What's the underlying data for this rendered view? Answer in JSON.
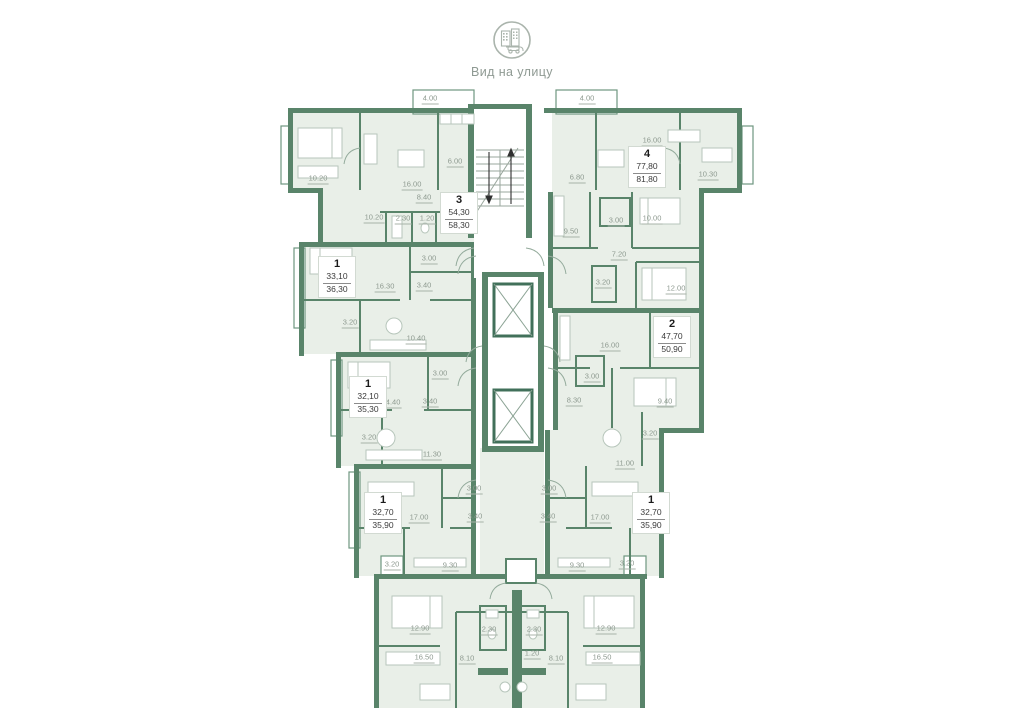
{
  "header": {
    "icon": "street-view-building-icon",
    "caption": "Вид на улицу"
  },
  "plan": {
    "colors": {
      "wall": "#59846a",
      "floor": "#e9efe8",
      "label_text": "#8d998f",
      "apartment_number": "#1b1b1b",
      "furniture": "#b7c6bb"
    },
    "apartments": [
      {
        "number": "3",
        "area_living": "54,30",
        "area_total": "58,30",
        "x": 440,
        "y": 192
      },
      {
        "number": "4",
        "area_living": "77,80",
        "area_total": "81,80",
        "x": 628,
        "y": 146
      },
      {
        "number": "1",
        "area_living": "33,10",
        "area_total": "36,30",
        "x": 318,
        "y": 256
      },
      {
        "number": "1",
        "area_living": "32,10",
        "area_total": "35,30",
        "x": 349,
        "y": 376
      },
      {
        "number": "2",
        "area_living": "47,70",
        "area_total": "50,90",
        "x": 653,
        "y": 316
      },
      {
        "number": "1",
        "area_living": "32,70",
        "area_total": "35,90",
        "x": 364,
        "y": 492
      },
      {
        "number": "1",
        "area_living": "32,70",
        "area_total": "35,90",
        "x": 632,
        "y": 492
      }
    ],
    "room_labels": [
      {
        "value": "4.00",
        "x": 430,
        "y": 100
      },
      {
        "value": "10.20",
        "x": 318,
        "y": 180
      },
      {
        "value": "16.00",
        "x": 412,
        "y": 186
      },
      {
        "value": "6.00",
        "x": 455,
        "y": 163
      },
      {
        "value": "8.40",
        "x": 424,
        "y": 199
      },
      {
        "value": "10.20",
        "x": 374,
        "y": 219
      },
      {
        "value": "2.30",
        "x": 403,
        "y": 220
      },
      {
        "value": "1.20",
        "x": 427,
        "y": 220
      },
      {
        "value": "4.00",
        "x": 587,
        "y": 100
      },
      {
        "value": "16.00",
        "x": 652,
        "y": 142
      },
      {
        "value": "6.80",
        "x": 577,
        "y": 179
      },
      {
        "value": "10.30",
        "x": 708,
        "y": 176
      },
      {
        "value": "9.50",
        "x": 571,
        "y": 233
      },
      {
        "value": "3.00",
        "x": 616,
        "y": 222
      },
      {
        "value": "10.00",
        "x": 652,
        "y": 220
      },
      {
        "value": "7.20",
        "x": 619,
        "y": 256
      },
      {
        "value": "3.20",
        "x": 603,
        "y": 284
      },
      {
        "value": "12.00",
        "x": 676,
        "y": 290
      },
      {
        "value": "16.30",
        "x": 385,
        "y": 288
      },
      {
        "value": "3.40",
        "x": 424,
        "y": 287
      },
      {
        "value": "3.00",
        "x": 429,
        "y": 260
      },
      {
        "value": "3.20",
        "x": 350,
        "y": 324
      },
      {
        "value": "10.40",
        "x": 416,
        "y": 340
      },
      {
        "value": "14.40",
        "x": 391,
        "y": 404
      },
      {
        "value": "3.00",
        "x": 440,
        "y": 375
      },
      {
        "value": "3.40",
        "x": 430,
        "y": 403
      },
      {
        "value": "3.20",
        "x": 369,
        "y": 439
      },
      {
        "value": "11.30",
        "x": 432,
        "y": 456
      },
      {
        "value": "17.00",
        "x": 419,
        "y": 519
      },
      {
        "value": "3.00",
        "x": 474,
        "y": 490
      },
      {
        "value": "3.40",
        "x": 475,
        "y": 518
      },
      {
        "value": "3.20",
        "x": 392,
        "y": 566
      },
      {
        "value": "9.30",
        "x": 450,
        "y": 567
      },
      {
        "value": "16.00",
        "x": 610,
        "y": 347
      },
      {
        "value": "3.00",
        "x": 592,
        "y": 378
      },
      {
        "value": "8.30",
        "x": 574,
        "y": 402
      },
      {
        "value": "9.40",
        "x": 665,
        "y": 403
      },
      {
        "value": "3.20",
        "x": 650,
        "y": 435
      },
      {
        "value": "11.00",
        "x": 625,
        "y": 465
      },
      {
        "value": "17.00",
        "x": 600,
        "y": 519
      },
      {
        "value": "3.00",
        "x": 549,
        "y": 490
      },
      {
        "value": "3.40",
        "x": 548,
        "y": 518
      },
      {
        "value": "9.30",
        "x": 577,
        "y": 567
      },
      {
        "value": "3.20",
        "x": 627,
        "y": 565
      },
      {
        "value": "12.90",
        "x": 420,
        "y": 630
      },
      {
        "value": "16.50",
        "x": 424,
        "y": 659
      },
      {
        "value": "8.10",
        "x": 467,
        "y": 660
      },
      {
        "value": "2.30",
        "x": 489,
        "y": 631
      },
      {
        "value": "12.90",
        "x": 606,
        "y": 630
      },
      {
        "value": "16.50",
        "x": 602,
        "y": 659
      },
      {
        "value": "8.10",
        "x": 556,
        "y": 660
      },
      {
        "value": "2.30",
        "x": 534,
        "y": 631
      },
      {
        "value": "1.20",
        "x": 532,
        "y": 655
      }
    ]
  }
}
